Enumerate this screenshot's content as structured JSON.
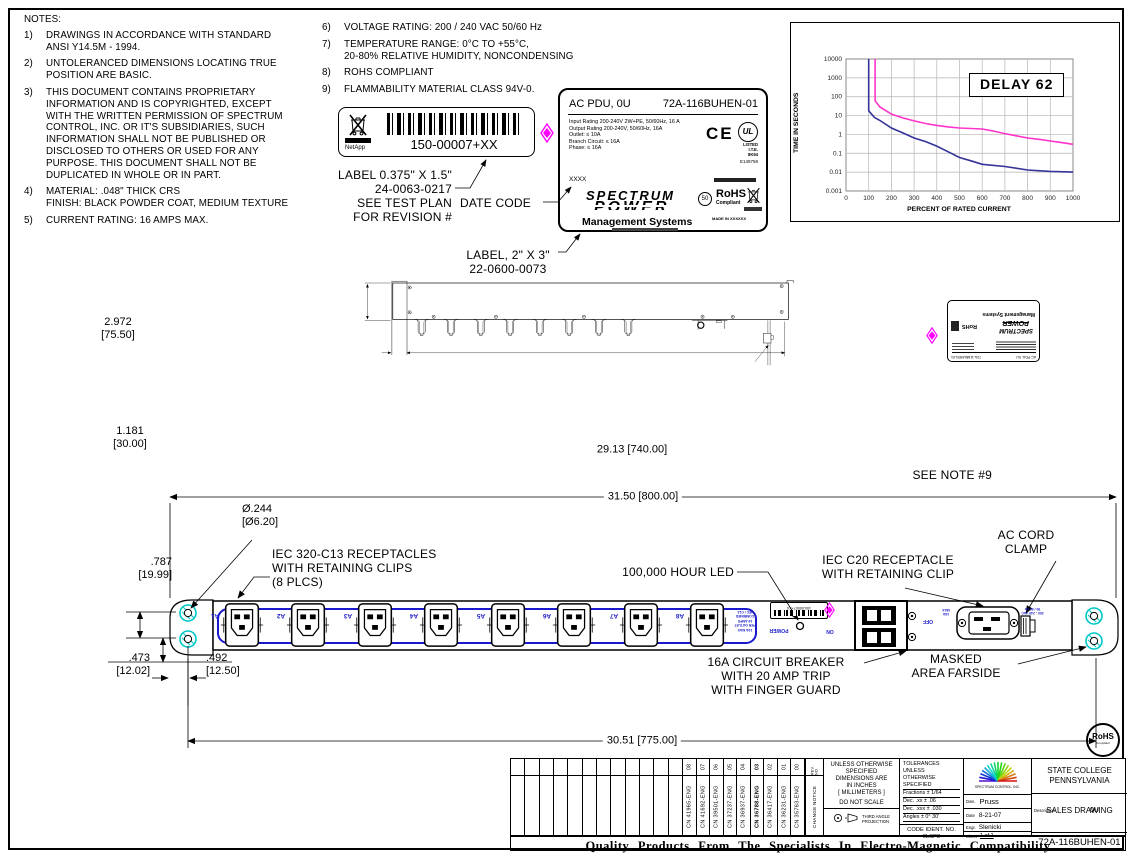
{
  "sheet": {
    "banner": "Quality Products From The Specialists In Electro-Magnetic Compatibility"
  },
  "notes_left": {
    "title": "NOTES:",
    "items": [
      {
        "num": "1)",
        "text": "DRAWINGS IN ACCORDANCE WITH STANDARD\nANSI Y14.5M - 1994."
      },
      {
        "num": "2)",
        "text": "UNTOLERANCED DIMENSIONS LOCATING TRUE\nPOSITION ARE BASIC."
      },
      {
        "num": "3)",
        "text": "THIS DOCUMENT CONTAINS PROPRIETARY\nINFORMATION AND IS COPYRIGHTED,  EXCEPT\nWITH THE WRITTEN PERMISSION OF SPECTRUM\nCONTROL, INC. OR IT'S SUBSIDIARIES, SUCH\nINFORMATION SHALL NOT BE PUBLISHED OR\nDISCLOSED TO OTHERS OR USED FOR ANY\nPURPOSE. THIS DOCUMENT SHALL NOT BE\nDUPLICATED IN WHOLE OR IN PART."
      },
      {
        "num": "4)",
        "text": "MATERIAL: .048\" THICK CRS\nFINISH: BLACK POWDER COAT, MEDIUM TEXTURE"
      },
      {
        "num": "5)",
        "text": "CURRENT RATING: 16 AMPS MAX."
      }
    ]
  },
  "notes_right": {
    "items": [
      {
        "num": "6)",
        "text": "VOLTAGE RATING: 200 / 240 VAC 50/60 Hz"
      },
      {
        "num": "7)",
        "text": "TEMPERATURE RANGE: 0°C TO +55°C,\n20-80% RELATIVE HUMIDITY, NONCONDENSING"
      },
      {
        "num": "8)",
        "text": "ROHS COMPLIANT"
      },
      {
        "num": "9)",
        "text": "FLAMMABILITY MATERIAL CLASS 94V-0."
      }
    ]
  },
  "barcode_label": {
    "part": "150-00007+XX",
    "brand": "NetApp",
    "callout": "LABEL 0.375\" X 1.5\"\n24-0063-0217\nSEE TEST PLAN\nFOR REVISION #",
    "date_code_callout": "DATE CODE"
  },
  "pdu_label": {
    "title": "AC PDU, 0U",
    "part": "72A-116BUHEN-01",
    "ratings": "Input Rating 200-240V 2W+PE, 50/60Hz, 16 A\nOutput Rating 200-240V, 50/60Hz, 16A\n  Outlet: ≤  10A\n  Branch Circuit: ≤ 16A\n  Phase: ≤ 16A",
    "ce": "CE",
    "ul": "UL",
    "ul_lines": "LISTED\nI.T.E.\n8K94",
    "ul_file": "E149758",
    "date_code": "XXXX",
    "logo_line1": "SPECTRUM",
    "logo_line2": "POWER",
    "logo_line3": "Management Systems",
    "circle50": "50",
    "rohs1": "RoHS",
    "rohs2": "Compliant",
    "made_in": "MADE IN XXXXXX",
    "callout": "LABEL, 2\" X 3\"\n22-0600-0073"
  },
  "chart_data": {
    "type": "line",
    "title": "DELAY 62",
    "xlabel": "PERCENT OF RATED CURRENT",
    "ylabel": "TIME IN SECONDS",
    "x_ticks": [
      0,
      100,
      200,
      300,
      400,
      500,
      600,
      700,
      800,
      900,
      1000
    ],
    "y_ticks": [
      10000,
      1000,
      100,
      10,
      1,
      0.1,
      0.01,
      0.001
    ],
    "y_scale": "log",
    "xlim": [
      0,
      1000
    ],
    "ylim": [
      0.001,
      10000
    ],
    "grid": true,
    "legend": "none",
    "series": [
      {
        "name": "blue-curve",
        "color": "#333399",
        "points": [
          [
            100,
            10000
          ],
          [
            100,
            18
          ],
          [
            125,
            8
          ],
          [
            150,
            5.5
          ],
          [
            200,
            2.2
          ],
          [
            250,
            1.2
          ],
          [
            300,
            0.65
          ],
          [
            350,
            0.42
          ],
          [
            400,
            0.24
          ],
          [
            450,
            0.12
          ],
          [
            500,
            0.06
          ],
          [
            550,
            0.04
          ],
          [
            600,
            0.026
          ],
          [
            700,
            0.02
          ],
          [
            800,
            0.013
          ],
          [
            900,
            0.011
          ],
          [
            1000,
            0.01
          ]
        ]
      },
      {
        "name": "magenta-curve",
        "color": "#ff33cc",
        "points": [
          [
            128,
            10000
          ],
          [
            128,
            60
          ],
          [
            150,
            28
          ],
          [
            200,
            12
          ],
          [
            250,
            7.5
          ],
          [
            300,
            5.2
          ],
          [
            350,
            3.8
          ],
          [
            400,
            3.0
          ],
          [
            450,
            2.5
          ],
          [
            500,
            2.2
          ],
          [
            550,
            2.05
          ],
          [
            600,
            1.95
          ],
          [
            650,
            1.5
          ],
          [
            700,
            1.1
          ],
          [
            750,
            0.85
          ],
          [
            800,
            0.65
          ],
          [
            850,
            0.55
          ],
          [
            900,
            0.45
          ],
          [
            950,
            0.37
          ],
          [
            1000,
            0.3
          ]
        ]
      }
    ]
  },
  "view_rear": {
    "dim_height": "2.972\n[75.50]",
    "dim_offset": "1.181\n[30.00]",
    "dim_width": "29.13 [740.00]",
    "see_note": "SEE NOTE #9"
  },
  "view_front": {
    "dim_hole": "Ø.244\n[Ø6.20]",
    "dim_spacing": ".787\n[19.99]",
    "dim_bottom": ".473\n[12.02]",
    "dim_inset": ".492\n[12.50]",
    "dim_overall": "31.50 [800.00]",
    "dim_mounting": "30.51 [775.00]",
    "receptacle_labels": [
      "A1",
      "A2",
      "A3",
      "A4",
      "A5",
      "A6",
      "A7",
      "A8"
    ],
    "callout_receptacles": "IEC 320-C13 RECEPTACLES\nWITH RETAINING CLIPS\n(8 PLCS)",
    "callout_led": "100,000 HOUR LED",
    "callout_c20": "IEC C20 RECEPTACLE\nWITH RETAINING CLIP",
    "callout_clamp": "AC CORD\nCLAMP",
    "callout_breaker": "16A CIRCUIT BREAKER\nWITH 20 AMP TRIP\nWITH FINGER GUARD",
    "callout_masked": "MASKED\nAREA FARSIDE",
    "silk_outlet": "10A MAX\nPER OUTLET\n16 AMPS\nCOMBINED\nIEC / C13",
    "silk_power": "POWER",
    "silk_on": "ON",
    "silk_off": "OFF",
    "silk_inlet_left": "16A\nMAX",
    "silk_inlet_right": "200 - 240 VAC\n50 / 60 Hz",
    "mini_barcode": "150-00007+XX"
  },
  "rohs_badge": {
    "line1": "RoHS",
    "line2": "Compliant"
  },
  "title_block": {
    "revisions": [
      {
        "rev": "08",
        "cn": "CN 41965-ENG",
        "bold": false
      },
      {
        "rev": "07",
        "cn": "CN 41692-ENG",
        "bold": false
      },
      {
        "rev": "06",
        "cn": "CN 39501-ENG",
        "bold": false
      },
      {
        "rev": "05",
        "cn": "CN 37237-ENG",
        "bold": false
      },
      {
        "rev": "04",
        "cn": "CN 36937-ENG",
        "bold": false
      },
      {
        "rev": "03",
        "cn": "CN 36788-ENG",
        "bold": true
      },
      {
        "rev": "02",
        "cn": "CN 36417-ENG",
        "bold": false
      },
      {
        "rev": "01",
        "cn": "CN 36231-ENG",
        "bold": false
      },
      {
        "rev": "00",
        "cn": "CN 35763-ENG",
        "bold": false
      }
    ],
    "rev_header_top": "REV. NO.",
    "rev_header_bottom": "CHANGE NOTICE",
    "unless": "UNLESS OTHERWISE\nSPECIFIED\nDIMENSIONS ARE\nIN INCHES\n[ MILLIMETERS ]",
    "do_not_scale": "DO NOT SCALE",
    "projection": "THIRD ANGLE\nPROJECTION",
    "tolerances": [
      "TOLERANCES UNLESS",
      "OTHERWISE SPECIFIED",
      "Fractions ± 1/64",
      "Dec. .xx ±   .06",
      "Dec. .xxx ±   .030",
      "Angles ± 0° 30'"
    ],
    "code_ident": "CODE IDENT. NO.\n0LSP2",
    "company": "SPECTRUM CONTROL, INC.",
    "city": "STATE COLLEGE\nPENNSYLVANIA",
    "dwn_label": "Dwn.",
    "dwn": "Pruss",
    "date_label": "Date",
    "date": "8-21-07",
    "engr_label": "Engr.",
    "engr": "Slenicki",
    "sheet_label": "Sheet",
    "sheet_value": "1  of  1",
    "desc_label": "Description",
    "desc1": "0U",
    "desc2": "SALES DRAWING",
    "part_number": "72A-116BUHEN-01"
  },
  "colors": {
    "silk_blue": "#1a1acc",
    "inspection_magenta": "#ff00ff",
    "masked_cyan": "#00c8c8"
  }
}
